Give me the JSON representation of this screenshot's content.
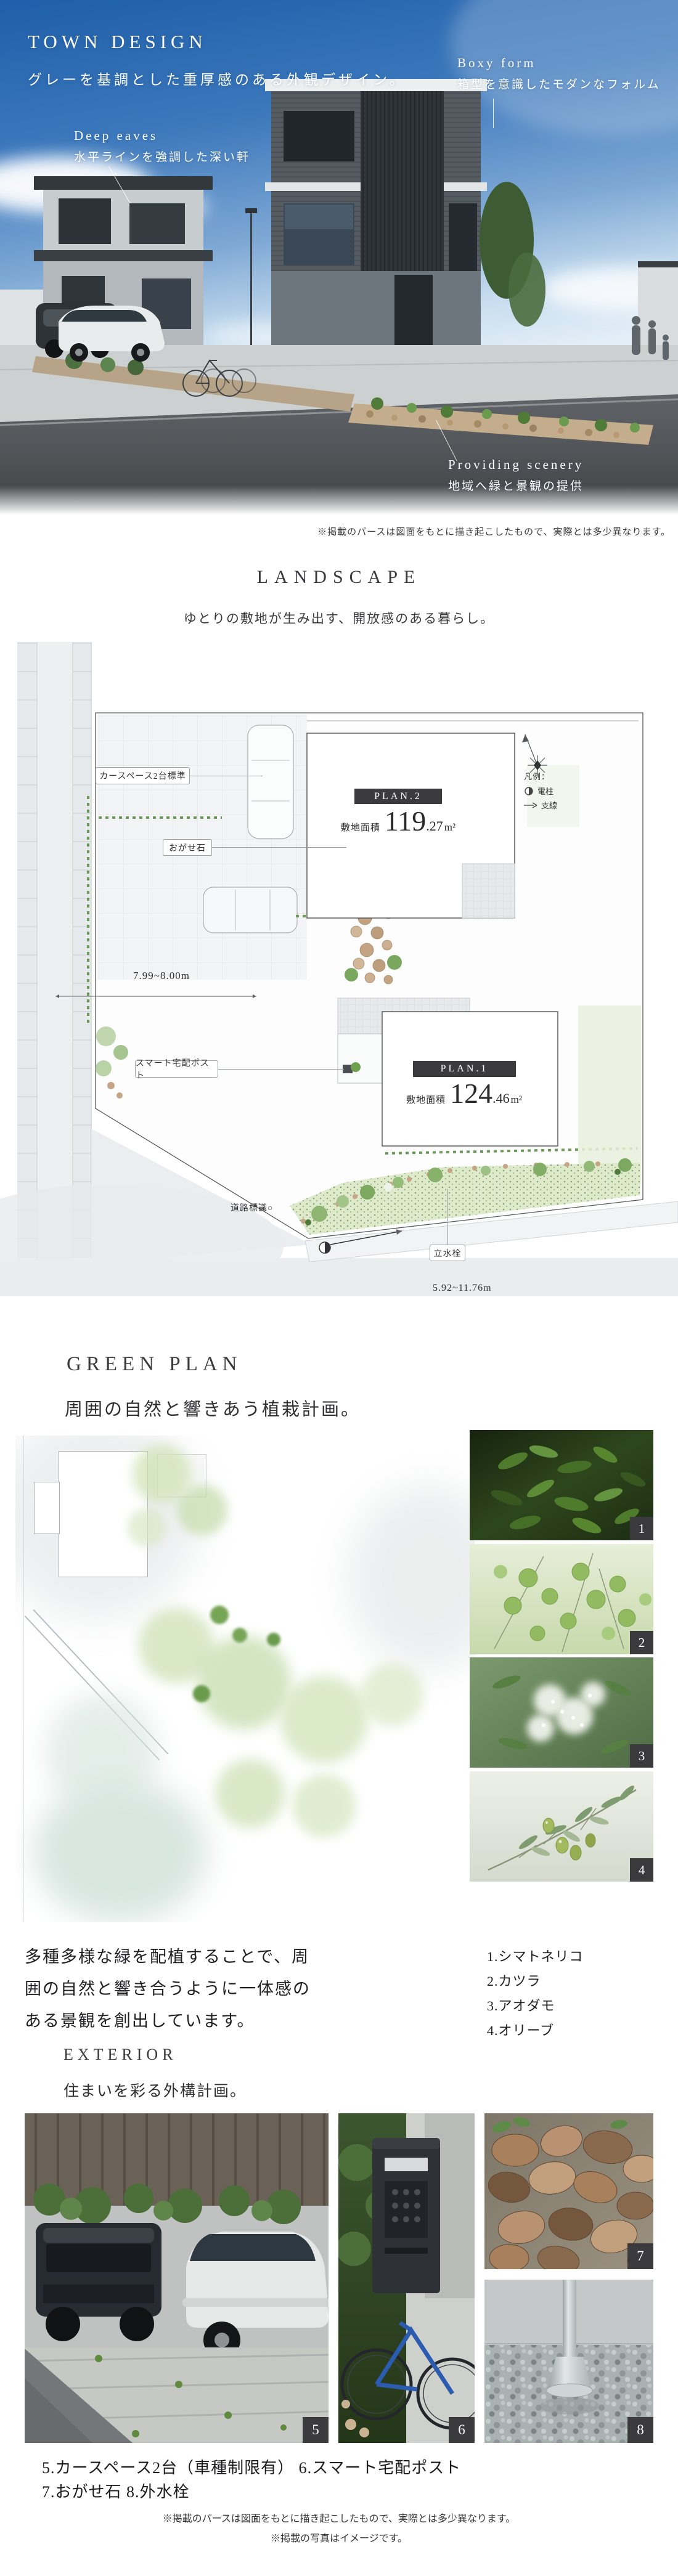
{
  "hero": {
    "title": "TOWN DESIGN",
    "subtitle": "グレーを基調とした重厚感のある外観デザイン。",
    "ann_boxy_en": "Boxy form",
    "ann_boxy_ja": "箱型を意識したモダンなフォルム",
    "ann_eaves_en": "Deep eaves",
    "ann_eaves_ja": "水平ラインを強調した深い軒",
    "ann_scenery_en": "Providing scenery",
    "ann_scenery_ja": "地域へ緑と景観の提供",
    "disclaimer": "※掲載のパースは図面をもとに描き起こしたもので、実際とは多少異なります。"
  },
  "landscape": {
    "title": "LANDSCAPE",
    "subtitle": "ゆとりの敷地が生み出す、開放感のある暮らし。",
    "plan2": {
      "name": "PLAN.2",
      "area_label": "敷地面積",
      "area_big": "119",
      "area_dec": ".27",
      "area_unit": "m²"
    },
    "plan1": {
      "name": "PLAN.1",
      "area_label": "敷地面積",
      "area_big": "124",
      "area_dec": ".46",
      "area_unit": "m²"
    },
    "label_car_space": "カースペース2台標準",
    "label_ogase": "おがせ石",
    "label_smart_post": "スマート宅配ポスト",
    "label_tap": "立水栓",
    "label_road_sign": "道路標識○",
    "dim_width_top": "7.99~8.00m",
    "dim_width_bottom": "5.92~11.76m",
    "legend_title": "凡例：",
    "legend_pole": "電柱",
    "legend_wire": "支線"
  },
  "green_plan": {
    "title": "GREEN PLAN",
    "subtitle": "周囲の自然と響きあう植栽計画。",
    "desc_line1": "多種多様な緑を配植することで、周",
    "desc_line2": "囲の自然と響き合うように一体感の",
    "desc_line3": "ある景観を創出しています。",
    "photos": [
      {
        "num": "1",
        "name": "1.シマトネリコ"
      },
      {
        "num": "2",
        "name": "2.カツラ"
      },
      {
        "num": "3",
        "name": "3.アオダモ"
      },
      {
        "num": "4",
        "name": "4.オリーブ"
      }
    ]
  },
  "exterior": {
    "title": "EXTERIOR",
    "subtitle": "住まいを彩る外構計画。",
    "badge5": "5",
    "badge6": "6",
    "badge7": "7",
    "badge8": "8",
    "caption_line1": "5.カースペース2台（車種制限有） 6.スマート宅配ポスト",
    "caption_line2": "7.おがせ石 8.外水栓",
    "disclaimer_line1": "※掲載のパースは図面をもとに描き起こしたもので、実際とは多少異なります。",
    "disclaimer_line2": "※掲載の写真はイメージです。"
  }
}
